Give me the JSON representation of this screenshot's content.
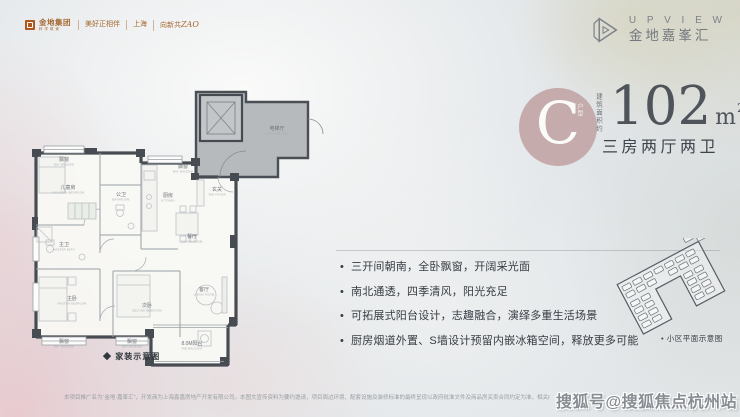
{
  "colors": {
    "accent_circle": "#c3a7a7",
    "wall": "#474c52",
    "elevator_hall_fill": "#b6babd",
    "brand_orange": "#a5682f",
    "text_dark": "#373c43",
    "text_gray": "#7d8288"
  },
  "header": {
    "brand": {
      "name": "金地集团",
      "sub": "科学筑家",
      "tagline": "美好正相伴",
      "city": "上海",
      "campaign_prefix": "向新共",
      "campaign_zao": "ZAO"
    },
    "project": {
      "logo_en": "U P V I E W",
      "name_cn": "金地嘉峯汇"
    }
  },
  "unit": {
    "type_letter": "C",
    "type_suffix": "户型",
    "area_label": "建筑面积约",
    "area_value": "102",
    "area_unit_base": "m",
    "area_unit_sup": "2",
    "layout": "三房两厅两卫"
  },
  "features": {
    "items": [
      "三开间朝南，全卧飘窗，开阔采光面",
      "南北通透，四季清风，阳光充足",
      "可拓展式阳台设计，志趣融合，演绎多重生活场景",
      "厨房烟道外置、S墙设计预留内嵌冰箱空间，释放更多可能"
    ]
  },
  "floorplan": {
    "caption": "◆ 家装示意图",
    "rooms": [
      {
        "id": "bay-window-top",
        "cn": "飘窗",
        "en": "BAY WINDOW",
        "x": 44,
        "y": 76
      },
      {
        "id": "children-bedroom",
        "cn": "儿童房",
        "en": "CHILDREN BEDROOM",
        "x": 48,
        "y": 104
      },
      {
        "id": "public-bath",
        "cn": "公卫",
        "en": "BATHROOM",
        "x": 101,
        "y": 111
      },
      {
        "id": "kitchen",
        "cn": "厨房",
        "en": "KITCHEN",
        "x": 148,
        "y": 112
      },
      {
        "id": "bay-window-kitchen",
        "cn": "飘窗",
        "en": "BAY WINDOW",
        "x": 163,
        "y": 83
      },
      {
        "id": "foyer",
        "cn": "玄关",
        "en": "THE FOYER",
        "x": 197,
        "y": 106
      },
      {
        "id": "dining-room",
        "cn": "餐厅",
        "en": "DINING ROOM",
        "x": 172,
        "y": 153
      },
      {
        "id": "master-bath",
        "cn": "主卫",
        "en": "MASTER BATH",
        "x": 44,
        "y": 161
      },
      {
        "id": "master-bedroom",
        "cn": "主卧",
        "en": "MASTER BEDROOM",
        "x": 52,
        "y": 215
      },
      {
        "id": "second-bedroom",
        "cn": "次卧",
        "en": "SECOND BEDROOM",
        "x": 127,
        "y": 222
      },
      {
        "id": "living-room",
        "cn": "客厅",
        "en": "LIVING ROOM",
        "x": 184,
        "y": 206
      },
      {
        "id": "bay-window-bottom-1",
        "cn": "飘窗",
        "en": "BAY WINDOW",
        "x": 44,
        "y": 258
      },
      {
        "id": "bay-window-bottom-2",
        "cn": "飘窗",
        "en": "BAY WINDOW",
        "x": 112,
        "y": 258
      },
      {
        "id": "balcony",
        "cn": "8.0M阳台",
        "en": "THE BALCONY",
        "x": 172,
        "y": 260
      },
      {
        "id": "elevator-hall",
        "cn": "电梯厅",
        "en": "ELEVATOR HALL",
        "x": 257,
        "y": 45
      }
    ]
  },
  "siteplan": {
    "caption": "• 小区平面示意图",
    "buildings": [
      [
        -43,
        -22
      ],
      [
        -31,
        -22
      ],
      [
        -19,
        -22
      ],
      [
        -7,
        -22
      ],
      [
        5,
        -22
      ],
      [
        17,
        -22
      ],
      [
        29,
        -22
      ],
      [
        -43,
        -14
      ],
      [
        -31,
        -14
      ],
      [
        -19,
        -14
      ],
      [
        5,
        -14
      ],
      [
        17,
        -14
      ],
      [
        29,
        -14
      ],
      [
        -43,
        -4
      ],
      [
        -31,
        -4
      ],
      [
        -43,
        4
      ],
      [
        -31,
        4
      ],
      [
        -43,
        12
      ],
      [
        -31,
        12
      ],
      [
        -43,
        20
      ],
      [
        -31,
        20
      ],
      [
        17,
        -4
      ],
      [
        29,
        -4
      ],
      [
        17,
        4
      ],
      [
        29,
        4
      ],
      [
        17,
        12
      ],
      [
        29,
        12
      ],
      [
        17,
        20
      ],
      [
        29,
        20
      ],
      [
        34,
        -36
      ],
      [
        46,
        -31
      ]
    ]
  },
  "footer": {
    "disclaimer": "本项目推广名为“金地·嘉峯汇”，开发商为上海鑫嘉房地产开发有限公司。本图文宣传资料为要约邀请，项目周边环境、配套设施及装修标准的最终呈现以政府批准文件及商品房买卖合同约定为准，相关内容仅供参考，不构成开发商的任何承诺。",
    "watermark": "搜狐号@搜狐焦点杭州站"
  }
}
